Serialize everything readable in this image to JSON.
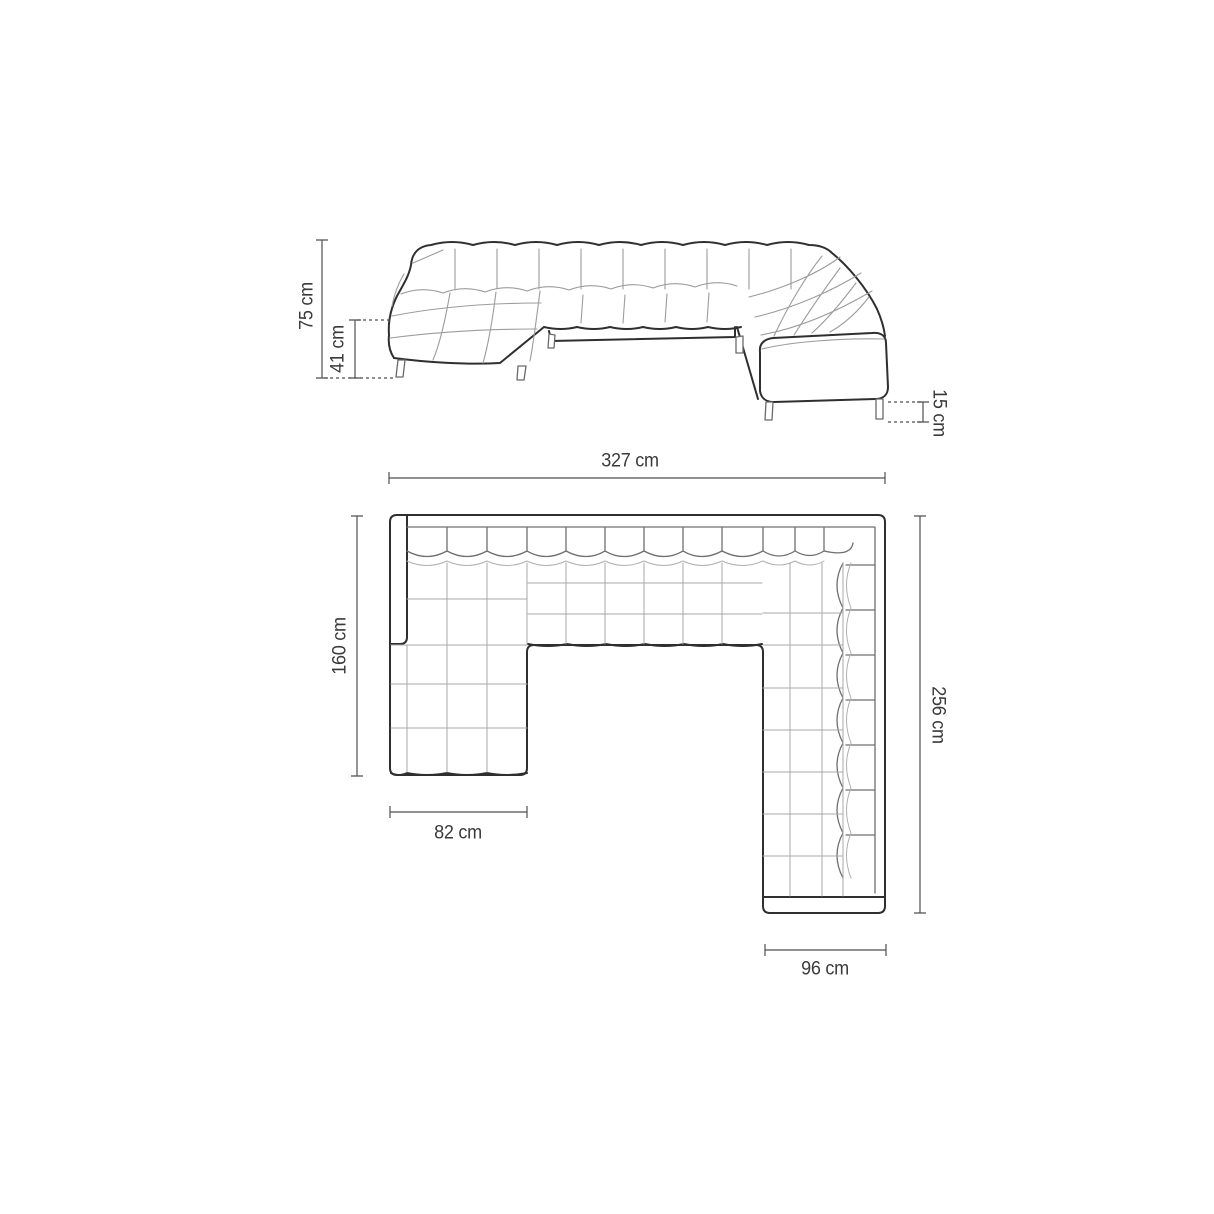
{
  "drawing": {
    "subject": "u-shaped-sectional-sofa-technical-drawing",
    "views": [
      "perspective-elevation",
      "top-plan"
    ],
    "colors": {
      "background": "#ffffff",
      "outline": "#2f2f2f",
      "tuft_seam": "#9c9c9c",
      "dimension_line": "#4f4f4f",
      "label_text": "#3a3a3a"
    }
  },
  "labels": {
    "total_height": "75 cm",
    "seat_height": "41 cm",
    "leg_height": "15 cm",
    "total_width": "327 cm",
    "left_depth": "160 cm",
    "right_depth": "256 cm",
    "chaise_width": "82 cm",
    "arm_width": "96 cm"
  }
}
